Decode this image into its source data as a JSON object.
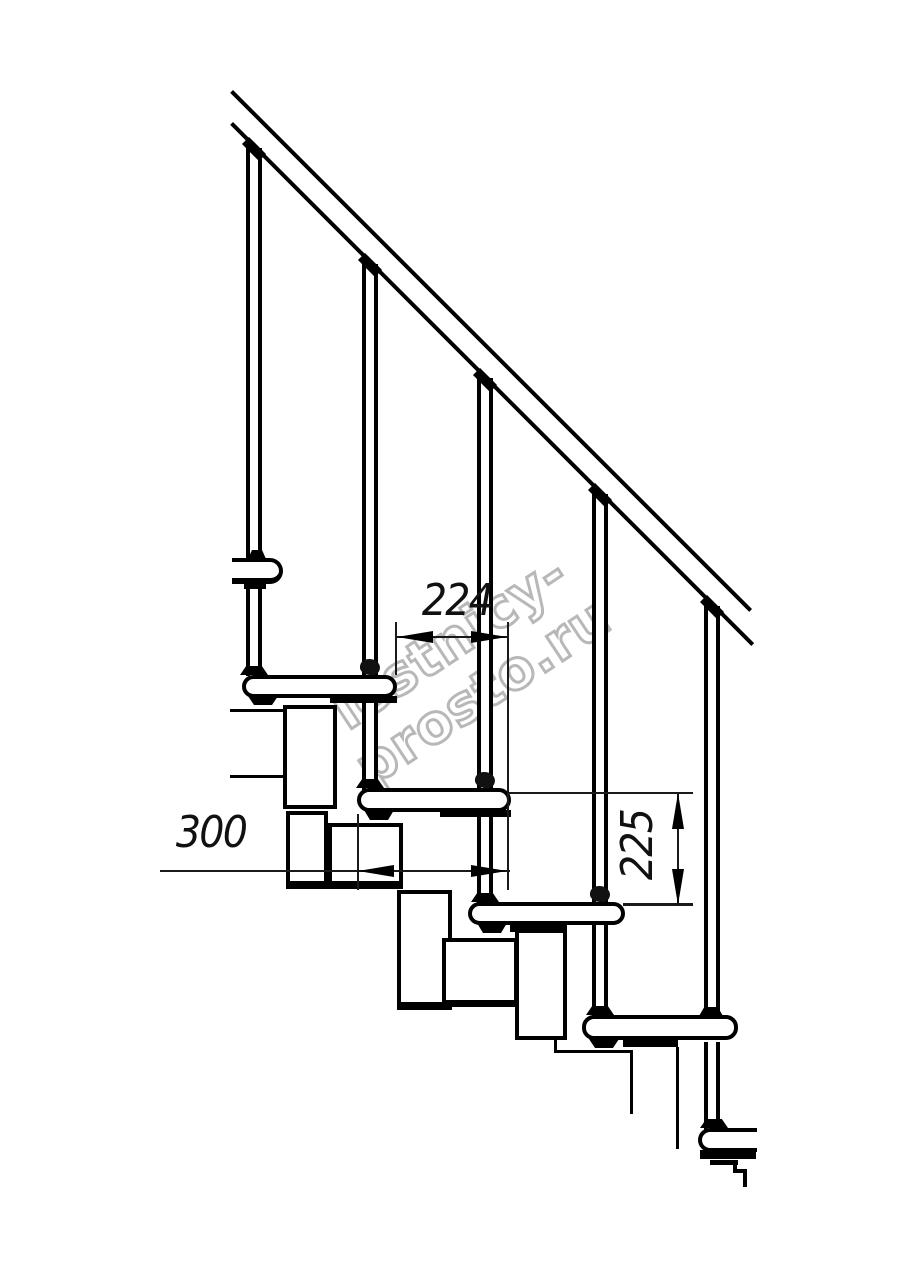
{
  "watermark": {
    "text": "lestnicy-prosto.ru",
    "color": "#a0a0a0"
  },
  "dimensions": {
    "step_offset_horizontal": {
      "value": "224",
      "orientation": "horizontal"
    },
    "tread_depth_horizontal": {
      "value": "300",
      "orientation": "horizontal"
    },
    "riser_height_vertical": {
      "value": "225",
      "orientation": "vertical"
    }
  },
  "colors": {
    "line": "#000000",
    "background": "#ffffff"
  }
}
